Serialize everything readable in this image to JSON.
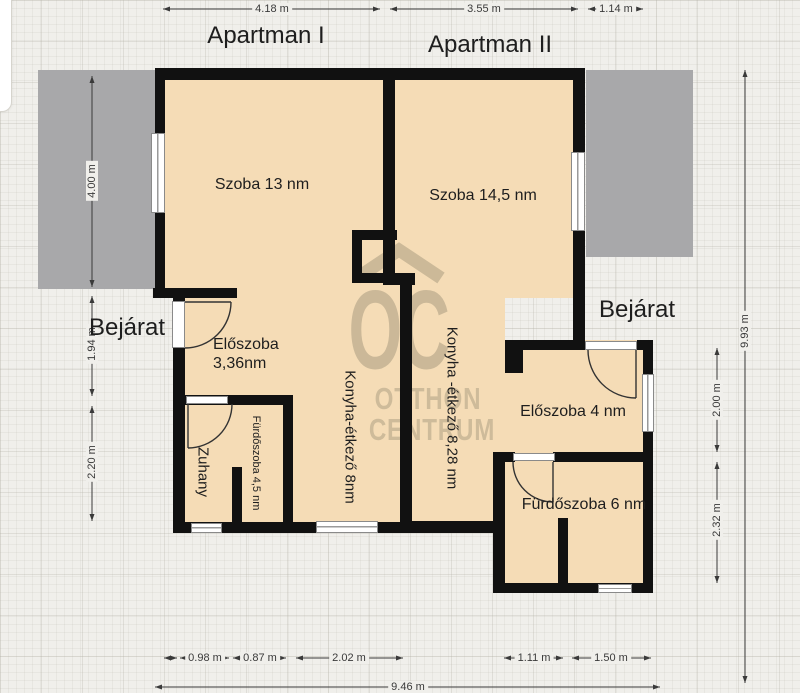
{
  "headers": {
    "apartman1": "Apartman I",
    "apartman2": "Apartman II"
  },
  "entrances": {
    "left": "Bejárat",
    "right": "Bejárat"
  },
  "rooms": {
    "szoba1": "Szoba 13 nm",
    "szoba2": "Szoba 14,5 nm",
    "eloszoba1_line1": "Előszoba",
    "eloszoba1_line2": "3,36nm",
    "konyha1": "Konyha-étkező 8nm",
    "konyha2": "Konyha -étkező 8,28 nm",
    "zuhany": "Zuhany",
    "furdo1": "Fürdőszoba 4,5 nm",
    "eloszoba2": "Előszoba 4 nm",
    "furdo2": "Fürdőszoba 6 nm"
  },
  "dimensions": {
    "top": [
      "4.18 m",
      "3.55 m",
      "1.14 m"
    ],
    "left": [
      "4.00 m",
      "1.94 m",
      "2.20 m"
    ],
    "right": [
      "9.93 m",
      "2.00 m",
      "2.32 m"
    ],
    "bottom": [
      "0.98 m",
      "0.87 m",
      "2.02 m",
      "1.11 m",
      "1.50 m"
    ],
    "bottom_total": "9.46 m"
  },
  "watermark": {
    "logo": "OC",
    "line1": "OTTHON",
    "line2": "CENTRUM"
  },
  "colors": {
    "background": "#f0efeb",
    "floor": "#f5dcb6",
    "wall": "#111111",
    "terrace": "#a8a8aa",
    "watermark": "#a99c80"
  }
}
